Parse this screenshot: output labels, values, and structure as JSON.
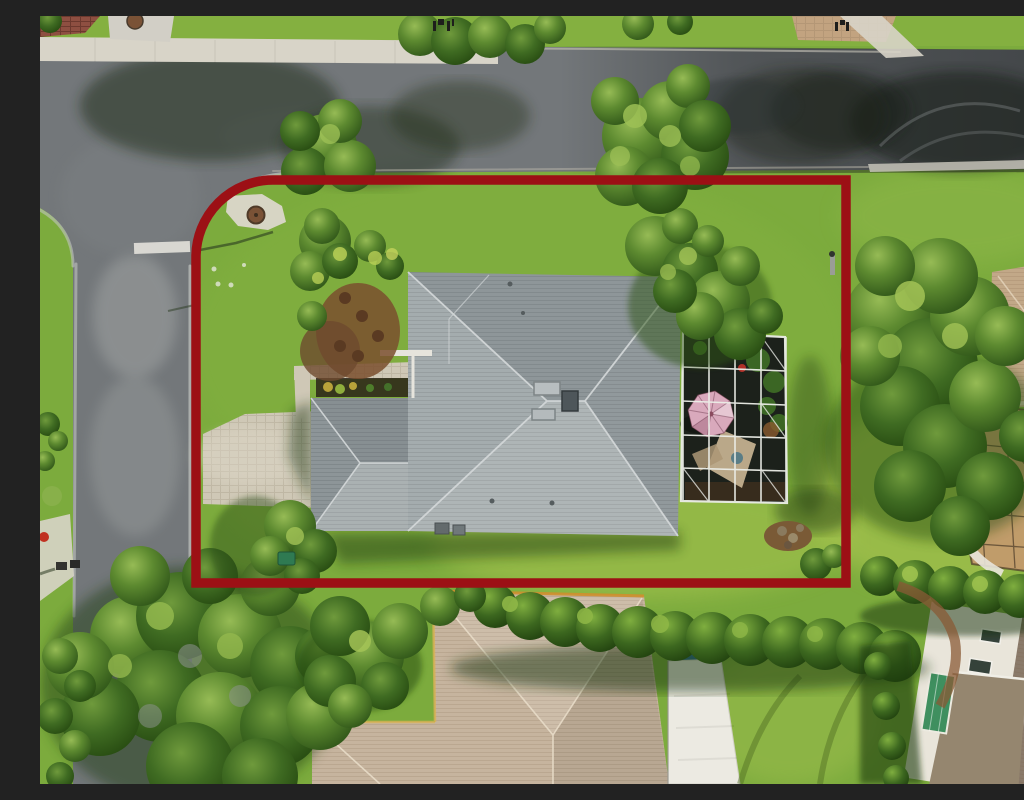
{
  "image": {
    "type": "aerial-photograph",
    "description": "Overhead drone view of a suburban corner lot outlined in red: gray hip-roof house with paver driveway, screened pool lanai with pink umbrella, lawns, hedges, mature trees, streets on two sides and neighboring homes",
    "width_px": 1024,
    "height_px": 768
  },
  "palette": {
    "grass_base": "#7cab3d",
    "asphalt": "#73777a",
    "sidewalk": "#d8d4c8",
    "concrete_apron": "#d2cfc6",
    "paver_driveway": "#cfc8b6",
    "brick_pavers": "#8e4f41",
    "tan_paver_apron": "#c2a380",
    "boundary_red": "#9c1015",
    "main_roof": "#a0a8aa",
    "garage_roof": "#9aa2a4",
    "cage_dark": "#1c211b",
    "cage_frame": "#eceee8",
    "umbrella_pink": "#d9a9bc",
    "patio_tan": "#c8b493",
    "south_roof_tan": "#c6b49e",
    "gutter_orange": "#cf8f2e",
    "lanai_white": "#eceae2",
    "solar_blue": "#2e6c8e",
    "east_roof_tan": "#c2a888",
    "east_lanai_floor": "#c29a6b",
    "white_house_wall": "#e9e5da",
    "se_roof_brown": "#8a7a6a",
    "green_glass": "#3f8f5f",
    "mulch_brown": "#7a4f2e",
    "drain_lid": "#7a5236",
    "hydrant_red": "#c03020",
    "utility_green": "#2f7a52"
  },
  "scene": {
    "property_boundary": "red outline around corner lot, rounded at street corner",
    "subject_house": "gray hip-roof single-story house with attached garage wing",
    "pool_enclosure": "dark screened lanai cage with white aluminum frame and pink patio umbrella",
    "driveway": "paver driveway from side street to garage",
    "streets": [
      "street along top",
      "side street along left",
      "curved corner intersection with crosswalk bar and storm drain"
    ],
    "neighbors": [
      "tan hip-roof house at bottom with white flat lanai roof and solar panel",
      "house with bronze screened lanai at right",
      "white two-story house at bottom right with green glass enclosure"
    ],
    "vegetation": [
      "front tropical planting beds with mulch",
      "hedgerow along rear lot line",
      "large shade trees over streets",
      "bright rear lawn"
    ]
  }
}
